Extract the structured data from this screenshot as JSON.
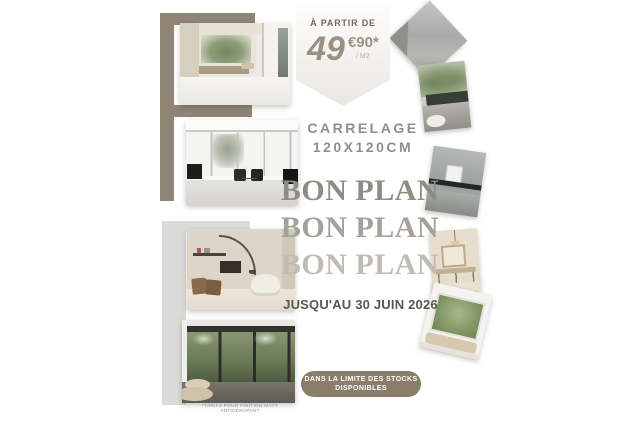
{
  "flyer": {
    "price_badge": {
      "prefix": "À PARTIR DE",
      "amount": "49",
      "cents": "€90*",
      "per_unit": "/ M2"
    },
    "product": {
      "line1": "CARRELAGE",
      "line2": "120X120CM"
    },
    "bon_plan": [
      {
        "label": "BON PLAN",
        "color": "#8f8b85"
      },
      {
        "label": "BON PLAN",
        "color": "#a5a29c"
      },
      {
        "label": "BON PLAN",
        "color": "#c0bcb2"
      }
    ],
    "deadline": "JUSQU'AU 30 JUIN 2026",
    "stock_note": {
      "line1": "DANS LA LIMITE DES STOCKS",
      "line2": "DISPONIBLES"
    },
    "footnote": "*TARIFS POUR FINITION MATT ANTIDÉRAPANT",
    "colors": {
      "taupe_bar": "#8e8577",
      "light_gray_bar": "#dadad8",
      "badge_fill": "#efedea",
      "price_text": "#9b9183",
      "product_text": "#8e8e8c",
      "deadline_text": "#5a564f",
      "stock_pill": "#8a7e6b",
      "background": "#ffffff"
    },
    "photos": [
      {
        "name": "courtyard-room-with-tree-view"
      },
      {
        "name": "living-room-black-armchairs"
      },
      {
        "name": "beige-living-room-arc-lamp"
      },
      {
        "name": "glass-wall-palm-view"
      },
      {
        "name": "gray-tile-sample-diamond"
      },
      {
        "name": "outdoor-terrace"
      },
      {
        "name": "gray-bathroom-console"
      },
      {
        "name": "beige-vanity-room"
      },
      {
        "name": "green-window-room"
      }
    ]
  }
}
